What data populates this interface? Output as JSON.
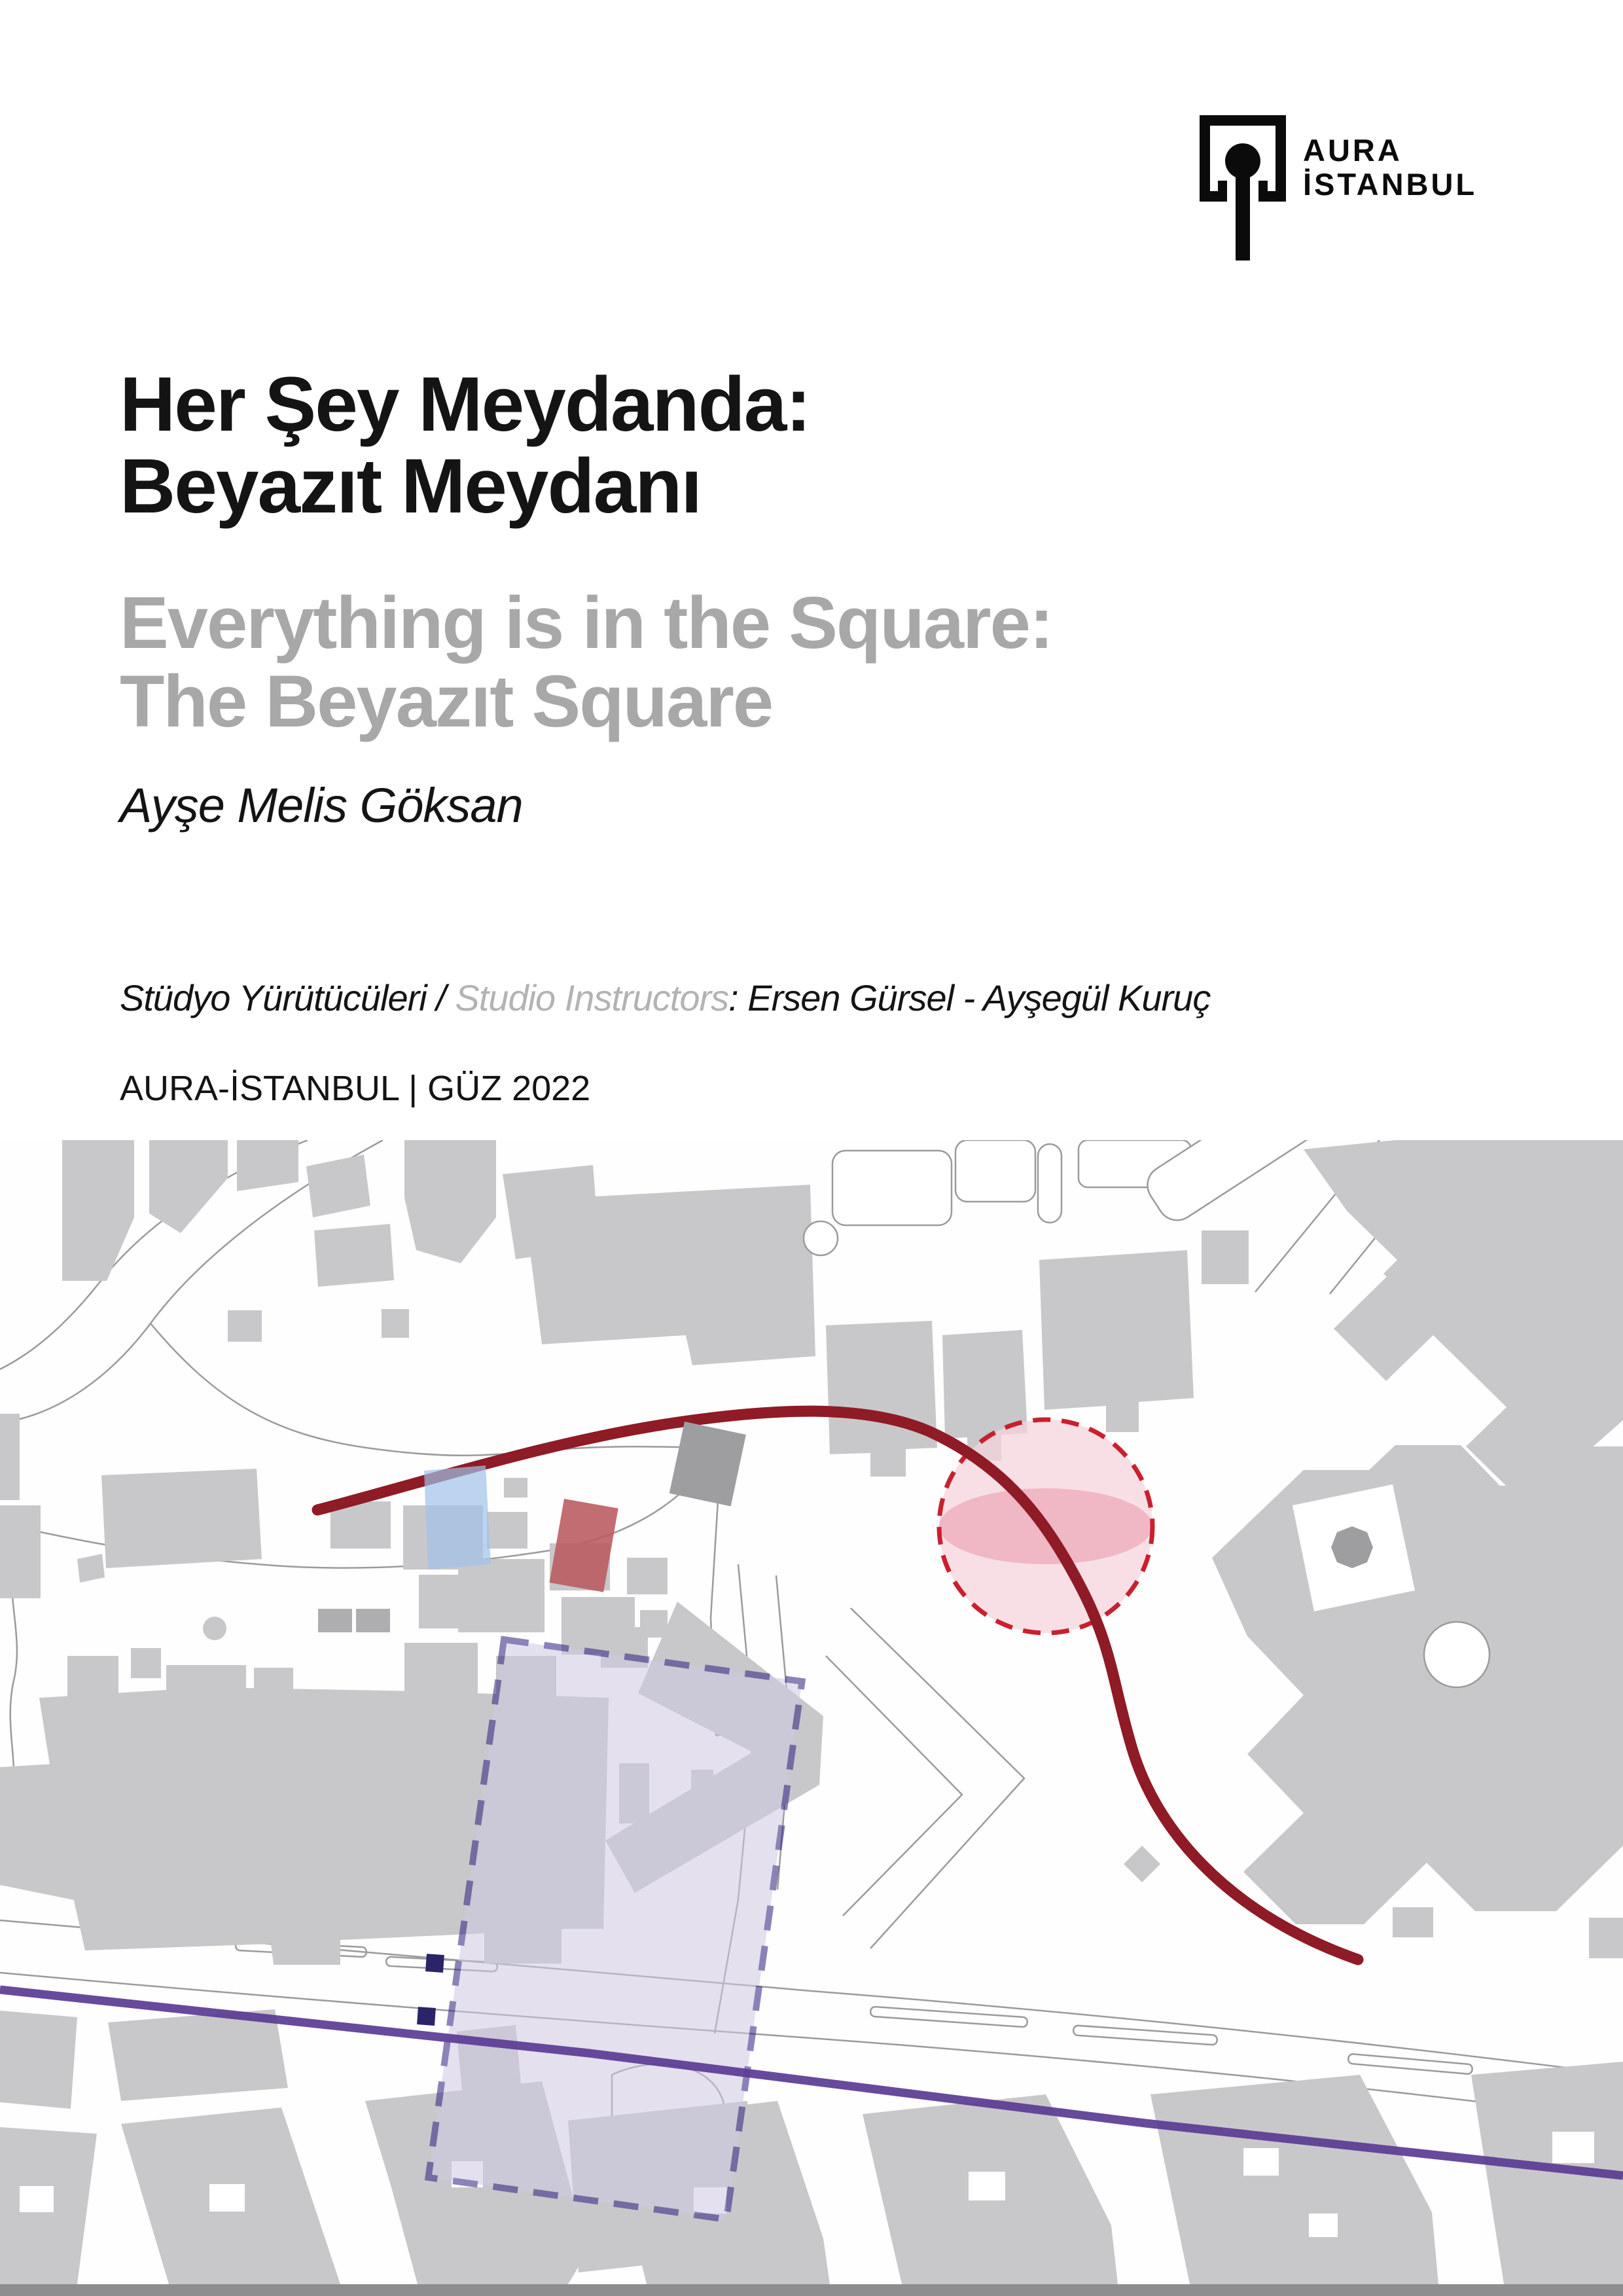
{
  "logo": {
    "line1": "AURA",
    "line2": "İSTANBUL"
  },
  "header": {
    "title_tr_line1": "Her Şey Meydanda:",
    "title_tr_line2": "Beyazıt Meydanı",
    "title_en_line1": "Everything is in the Square:",
    "title_en_line2": "The Beyazıt Square",
    "author": "Ayşe Melis Göksan",
    "credits_tr": "Stüdyo Yürütücüleri / ",
    "credits_en": "Studio Instructors",
    "credits_names": ": Ersen Gürsel - Ayşegül Kuruç",
    "edition": "AURA-İSTANBUL | GÜZ 2022"
  },
  "map": {
    "annotations": [
      {
        "name": "route-line",
        "style": "thick dark red curve through the square"
      },
      {
        "name": "focus-area-circle",
        "style": "red dashed circle with pink fill and darker pink lens core"
      },
      {
        "name": "study-area-rectangle",
        "style": "tilted lavender rectangle with dark indigo dashed border"
      },
      {
        "name": "tram-line",
        "style": "purple diagonal line across lower map"
      },
      {
        "name": "landmark-blue-square",
        "style": "translucent blue square"
      },
      {
        "name": "landmark-red-square",
        "style": "muted red tilted square"
      },
      {
        "name": "landmark-navy-squares",
        "style": "two small dark indigo squares"
      }
    ]
  },
  "colors": {
    "building": "#C8C8CA",
    "building_dark": "#9E9EA1",
    "street": "#9B9B9B",
    "route_red": "#8E1B26",
    "circle_stroke": "#C9202F",
    "circle_fill": "#F5D4DC",
    "lens_fill": "#EFB0BF",
    "area_fill": "#CFC8E2",
    "area_stroke": "#2E2080",
    "tram_purple": "#5A3B94",
    "navy": "#2B2468",
    "landmark_blue": "#9FC2E8",
    "landmark_red": "#B9595E",
    "strip_gray": "#8D8D8F",
    "title_black": "#141414",
    "title_gray": "#A8A8A8",
    "credit_gray": "#B3B3B3"
  }
}
